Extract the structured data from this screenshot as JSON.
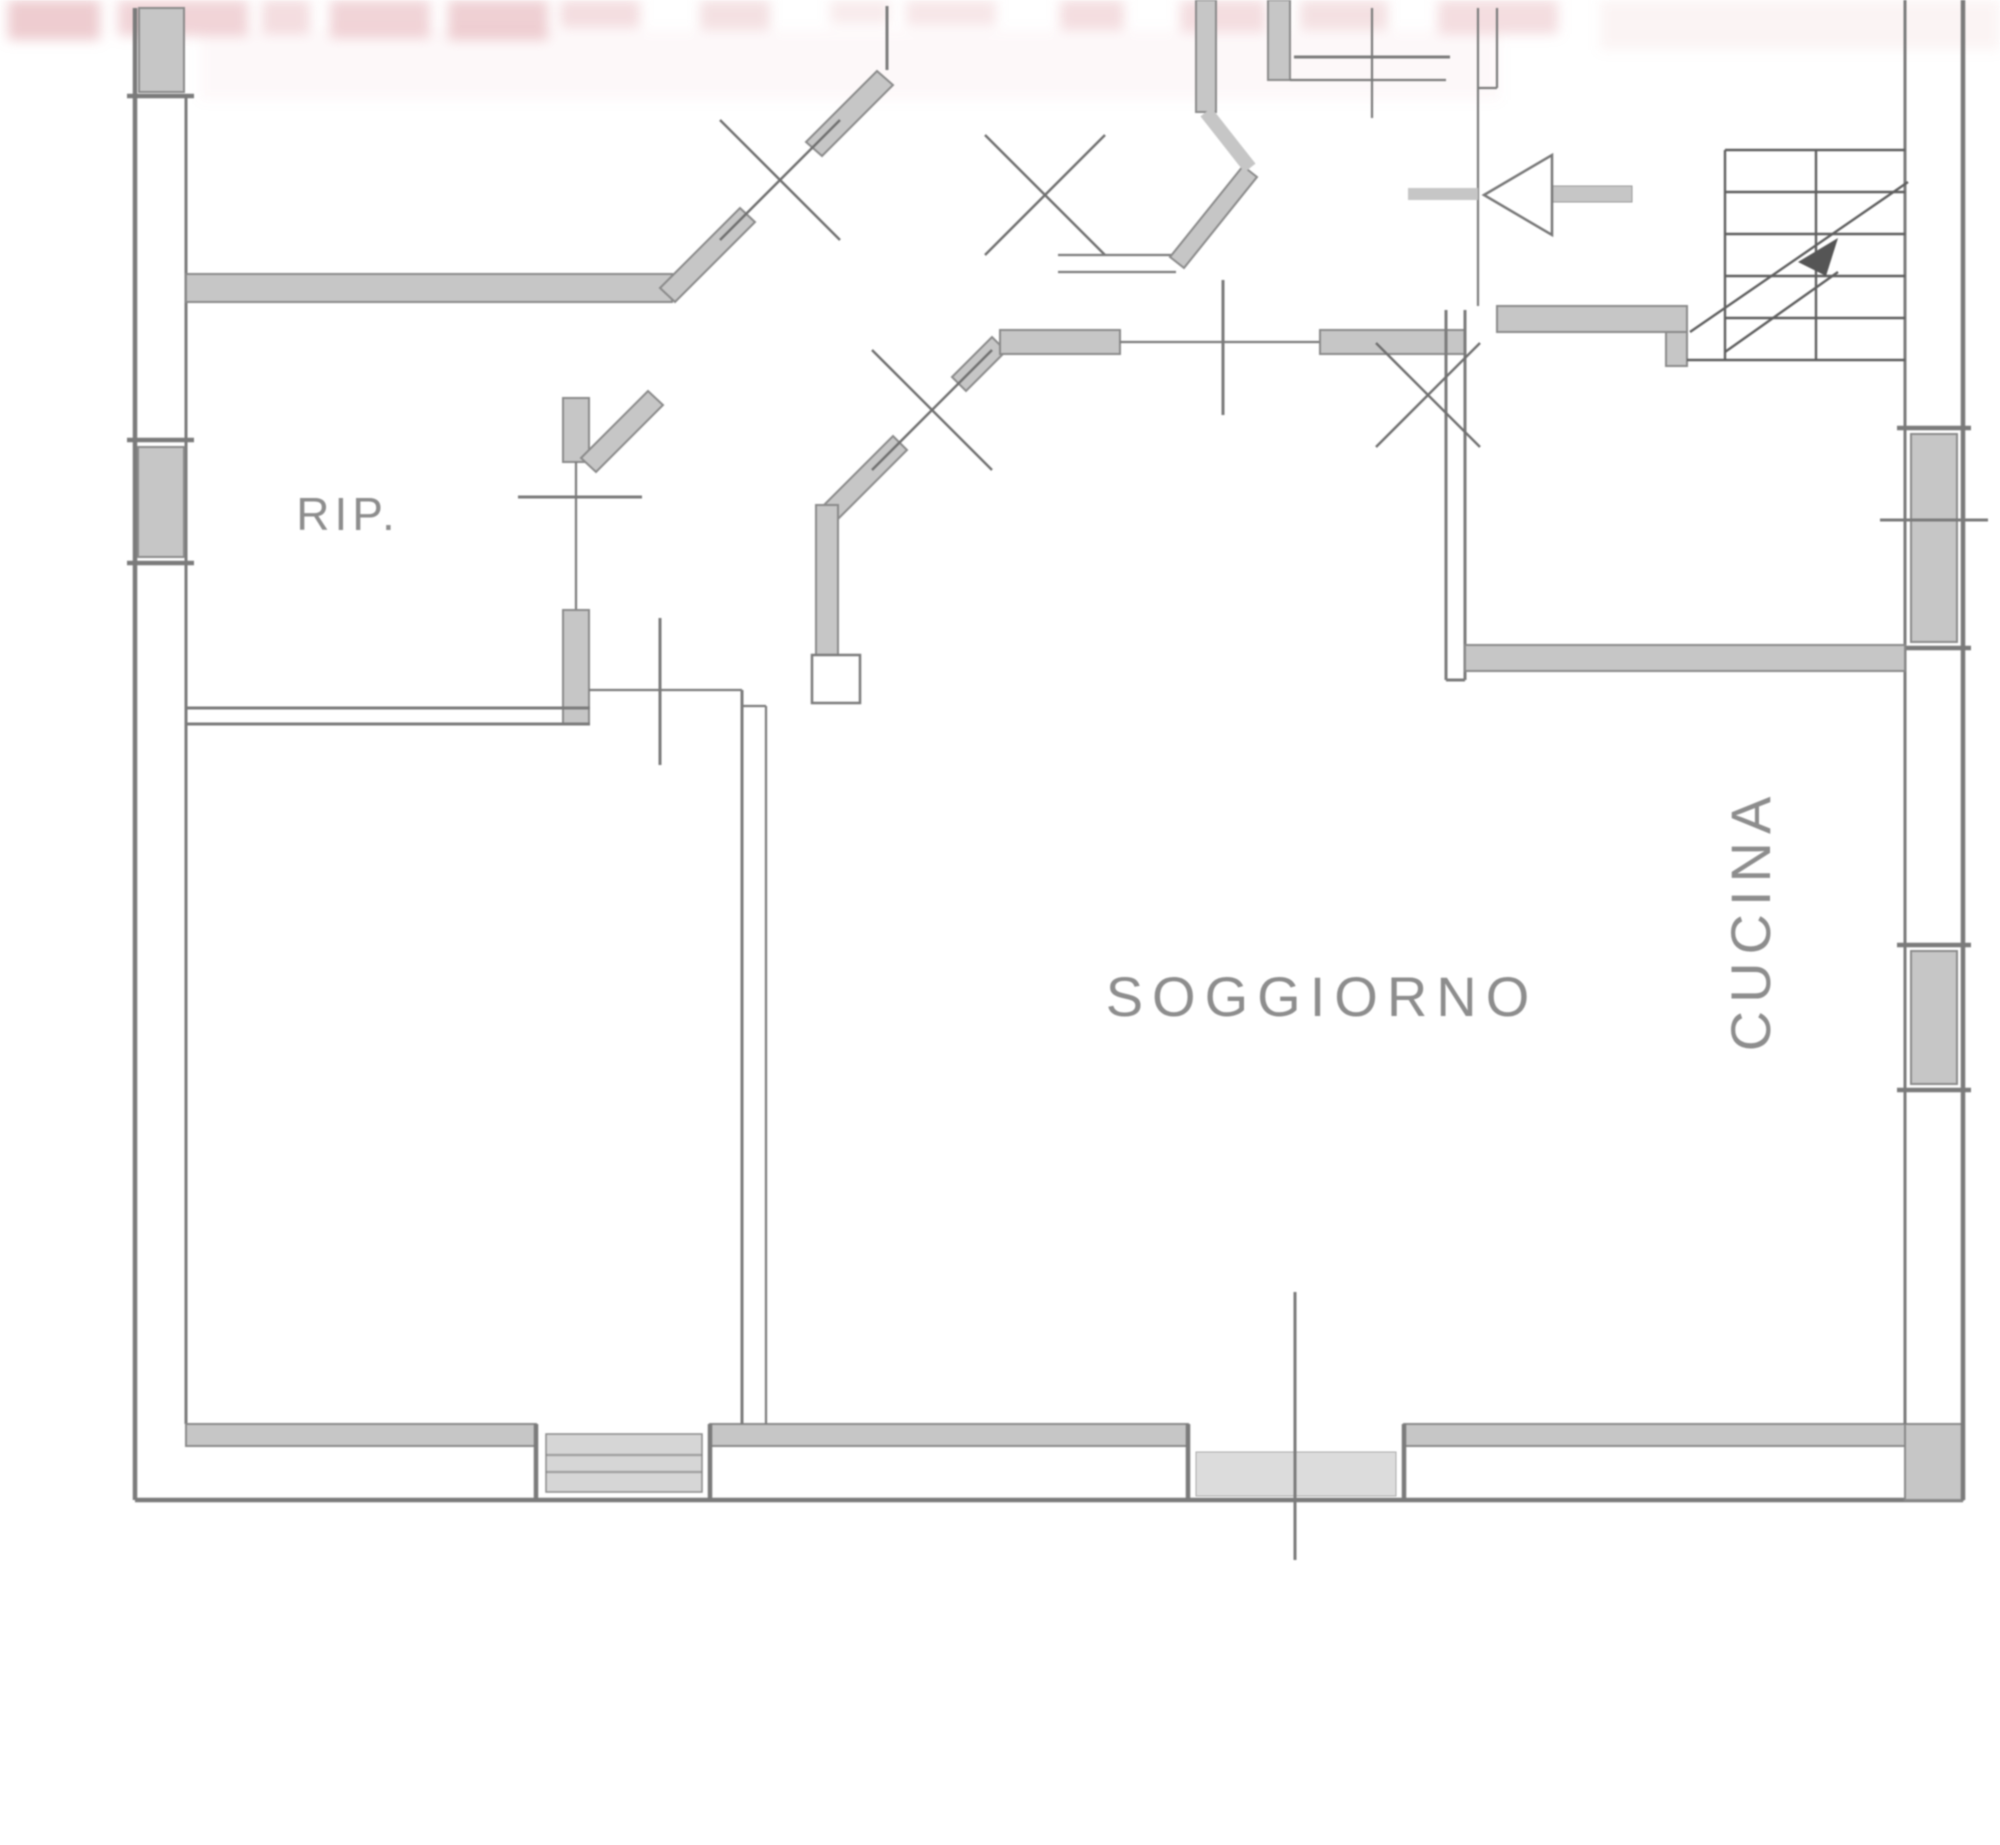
{
  "plan": {
    "title": "apartment-floor-plan",
    "rooms": [
      {
        "label": "RIP."
      },
      {
        "label": "SOGGIORNO"
      },
      {
        "label": "CUCINA"
      }
    ],
    "symbols": [
      "stairs-icon",
      "door-swing-x-icon",
      "door-leaf-triangle-icon",
      "window-icon",
      "entrance-axis-tick-icon"
    ],
    "watermark": {
      "description": "cut-off red watermark letters",
      "color": "#d98f97"
    },
    "colors": {
      "background": "#ffffff",
      "wall_fill": "#c6c6c6",
      "wall_edge": "#8a8a8a",
      "line": "#7b7b7b",
      "label_text": "#8d8d8d",
      "sill_fill": "#d6d6d6",
      "watermark_pink": "#d98f97"
    }
  }
}
